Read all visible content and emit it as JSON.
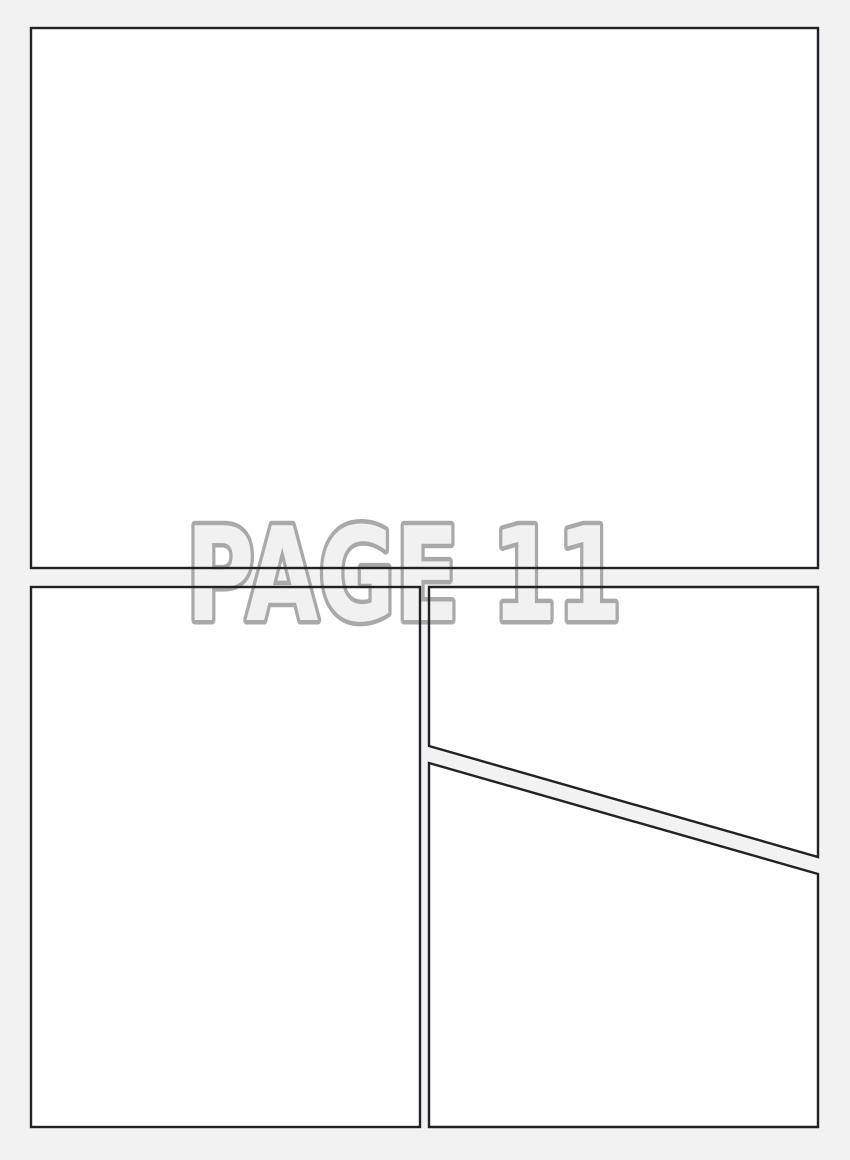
{
  "page": {
    "type": "blank-comic-page-template",
    "watermark": {
      "text": "PAGE 11"
    },
    "panel_count": 4,
    "colors": {
      "background": "#f2f2f2",
      "panel_fill": "#ffffff",
      "panel_border": "#212126",
      "watermark_stroke": "#a9a9a9",
      "watermark_fill": "#f1f1f1"
    }
  }
}
